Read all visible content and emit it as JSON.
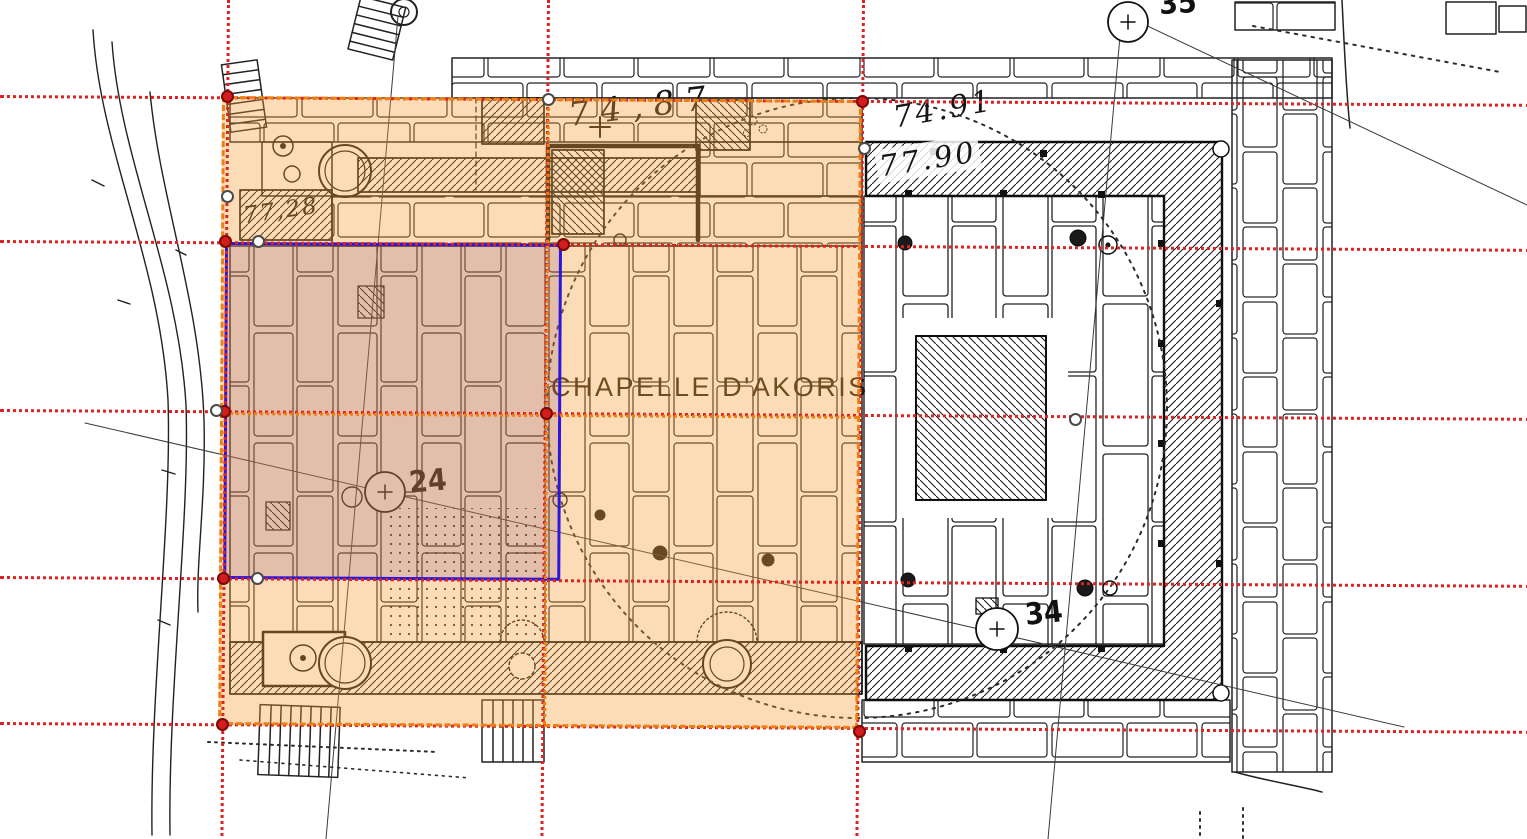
{
  "page": {
    "kind": "archaeological-site-plan annotation view",
    "background": "#ffffff"
  },
  "plan": {
    "title": "CHAPELLE D'AKORIS",
    "elevation_labels": [
      {
        "text": "74,87"
      },
      {
        "text": "74.91"
      },
      {
        "text": "77.90"
      },
      {
        "text": "77,28"
      }
    ],
    "survey_markers": [
      {
        "label": "24"
      },
      {
        "label": "34"
      },
      {
        "label": "35"
      }
    ]
  },
  "overlays": {
    "orange_region": {
      "border_color": "#ee7f10",
      "fill": "rgba(244,158,54,0.36)",
      "grid_rows": 2,
      "grid_cols": 2
    },
    "blue_selection": {
      "border_color": "#2b16e0",
      "fill": "rgba(110,50,120,0.17)"
    },
    "guide_lines": {
      "color": "#da2424",
      "horizontal_y": [
        95,
        240,
        409,
        576,
        722
      ],
      "vertical_x": [
        227,
        547,
        862
      ]
    },
    "handles": {
      "red_color": "#d31c1c",
      "red_ring": "#7c0808",
      "white_color": "#ffffff",
      "white_ring": "#4a4a4a",
      "red": [
        {
          "x": 227,
          "y": 96
        },
        {
          "x": 862,
          "y": 101
        },
        {
          "x": 222,
          "y": 724
        },
        {
          "x": 859,
          "y": 731
        },
        {
          "x": 225,
          "y": 241
        },
        {
          "x": 563,
          "y": 244
        },
        {
          "x": 224,
          "y": 411
        },
        {
          "x": 546,
          "y": 413
        },
        {
          "x": 223,
          "y": 578
        }
      ],
      "white": [
        {
          "x": 548,
          "y": 99
        },
        {
          "x": 227,
          "y": 196
        },
        {
          "x": 258,
          "y": 241
        },
        {
          "x": 216,
          "y": 410
        },
        {
          "x": 257,
          "y": 578
        },
        {
          "x": 864,
          "y": 148
        },
        {
          "x": 1075,
          "y": 419
        }
      ]
    }
  }
}
